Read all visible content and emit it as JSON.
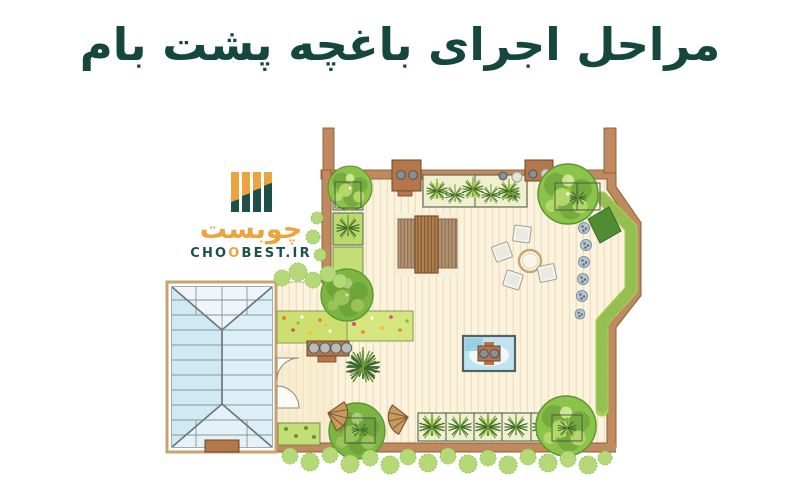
{
  "theme": {
    "title_color": "#15473e",
    "logo_orange": "#eca43e",
    "logo_green": "#1d5147",
    "wall": "#c08a5e",
    "wall_dark": "#8a5f3c",
    "deck": "#fbf3dd",
    "plank": "#eee0bd",
    "tree_light": "#b9dc6d",
    "tree_mid": "#8cc34b",
    "tree_dark": "#5f9634",
    "hedge": "#a6d05b",
    "bush": "#b5d977",
    "lime": "#cde06f",
    "grass": "#3c672e",
    "glass": "#cfeaf3",
    "frame": "#7d858b",
    "water": "#bfe4f0",
    "wood": "#b5764a",
    "wicker": "#c89a5e",
    "chair": "#f4f3ec",
    "metal": "#8a8f93"
  },
  "title": {
    "text": "مراحل اجرای باغچه پشت بام"
  },
  "logo": {
    "wordmark": "چوبست",
    "domain_prefix": "CHO",
    "accent_letter": "O",
    "domain_suffix": "BEST.IR"
  }
}
